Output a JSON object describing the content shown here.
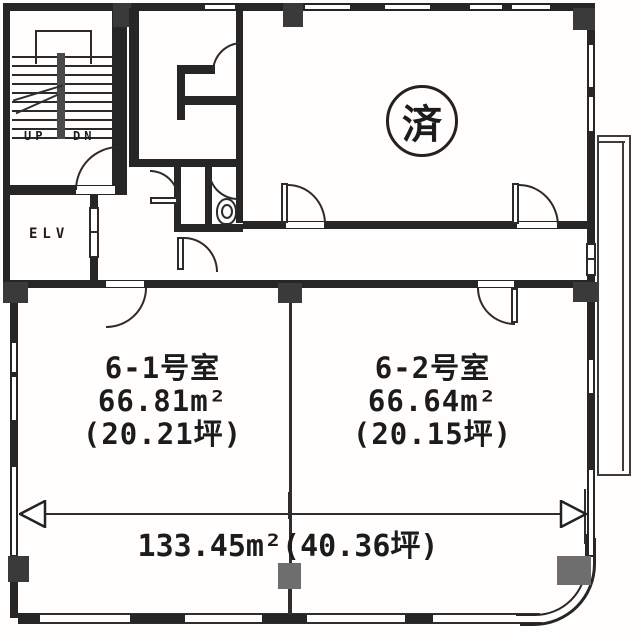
{
  "floorplan": {
    "stairs": {
      "up_label": "UP",
      "dn_label": "DN"
    },
    "elevator": {
      "label": "ELV"
    },
    "stamp": {
      "label": "済"
    },
    "rooms": [
      {
        "name": "6-1号室",
        "area_m2": "66.81m²",
        "area_tsubo": "(20.21坪)"
      },
      {
        "name": "6-2号室",
        "area_m2": "66.64m²",
        "area_tsubo": "(20.15坪)"
      }
    ],
    "total_dimension": {
      "label": "133.45m²(40.36坪)"
    },
    "colors": {
      "wall": "#262626",
      "gray_column": "#6e6e6e",
      "background": "#ffffff"
    }
  }
}
